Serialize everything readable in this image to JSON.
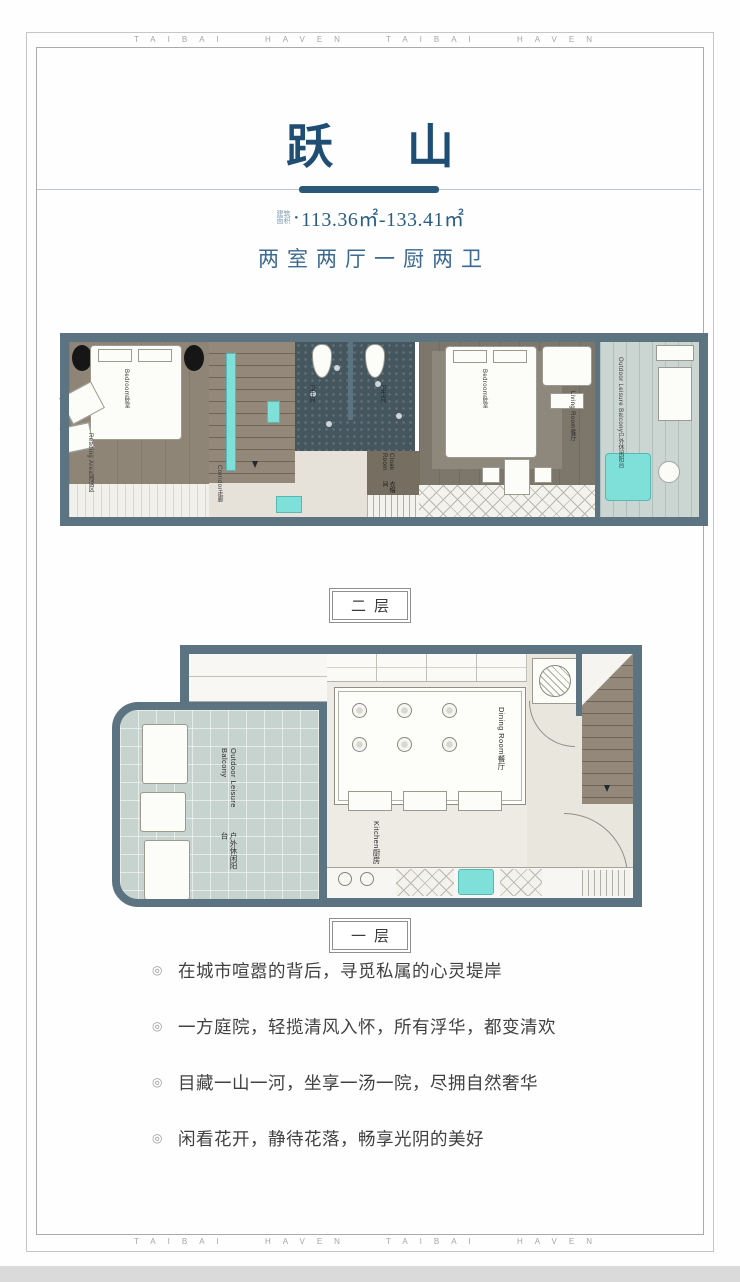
{
  "frame": {
    "brand_text": "TAIBAI HAVEN TAIBAI HAVEN"
  },
  "header": {
    "title": "跃 山",
    "area_label": "建筑面积",
    "area_dot": "●",
    "area_value": "113.36㎡-133.41㎡",
    "room_type": "两室两厅一厨两卫"
  },
  "floor2": {
    "tag": "二层",
    "rooms": {
      "bedroom_left": {
        "zh": "卧室",
        "en": "Bedroom"
      },
      "reading_area": {
        "zh": "阅读区",
        "en": "Reading Area"
      },
      "corridor": {
        "zh": "走廊",
        "en": "Corridor"
      },
      "bathroom_left": {
        "zh": "卫生间",
        "en": ""
      },
      "bathroom_right": {
        "zh": "卫生间",
        "en": ""
      },
      "cloak_room": {
        "zh": "衣帽间",
        "en": "Cloak Room"
      },
      "bedroom_right": {
        "zh": "卧室",
        "en": "Bedroom"
      },
      "living_room": {
        "zh": "客厅",
        "en": "Living Room"
      },
      "balcony": {
        "zh": "户外休闲阳台",
        "en": "Outdoor Leisure Balcony"
      }
    }
  },
  "floor1": {
    "tag": "一层",
    "rooms": {
      "balcony": {
        "zh": "户外休闲阳台",
        "en": "Outdoor Leisure Balcony"
      },
      "dining_room": {
        "zh": "餐厅",
        "en": "Dining Room"
      },
      "kitchen": {
        "zh": "厨房",
        "en": "Kitchen"
      }
    }
  },
  "bullets": {
    "glyph": "◎",
    "items": [
      "在城市喧嚣的背后，寻觅私属的心灵堤岸",
      "一方庭院，轻揽清风入怀，所有浮华，都变清欢",
      "目藏一山一河，坐享一汤一院，尽拥自然奢华",
      "闲看花开，静待花落，畅享光阴的美好"
    ]
  },
  "colors": {
    "title_blue": "#1f4e74",
    "text_blue": "#3c6a90",
    "wall_slate": "#5c7482",
    "accent_cyan": "#7fe0da"
  }
}
